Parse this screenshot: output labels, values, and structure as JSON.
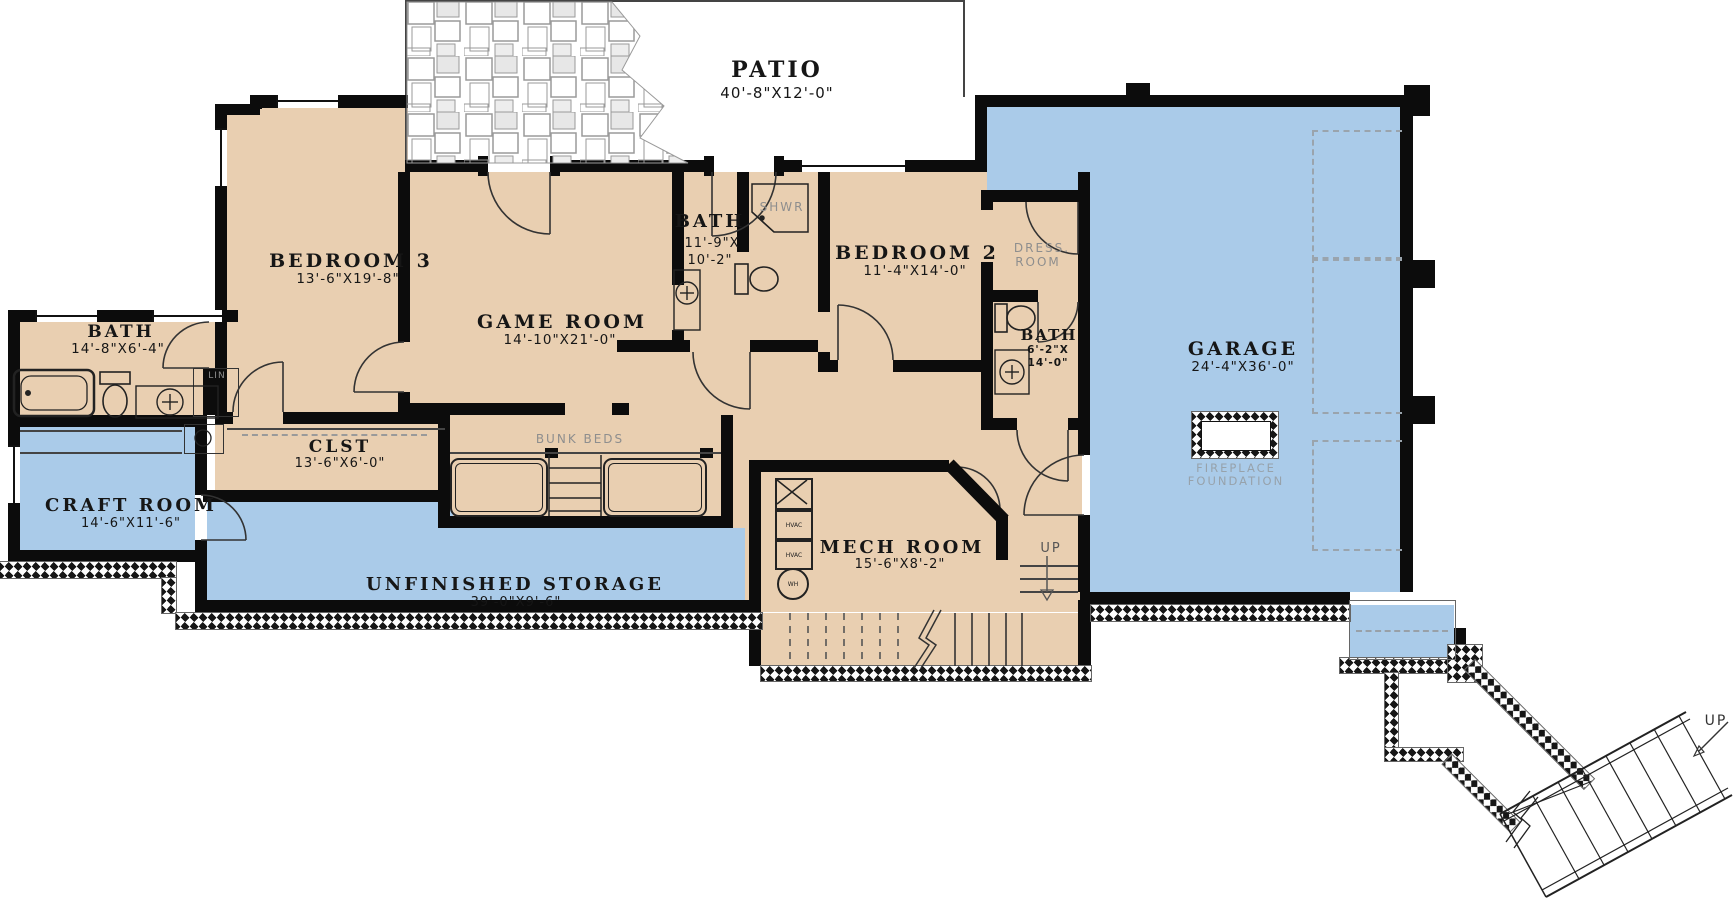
{
  "plan_title": "Basement Floor Plan",
  "rooms": {
    "patio": {
      "name": "PATIO",
      "dims": "40'-8\"X12'-0\""
    },
    "bedroom3": {
      "name": "BEDROOM 3",
      "dims": "13'-6\"X19'-8\""
    },
    "game_room": {
      "name": "GAME ROOM",
      "dims": "14'-10\"X21'-0\""
    },
    "bath_center": {
      "name": "BATH",
      "dims_l1": "11'-9\"X",
      "dims_l2": "10'-2\""
    },
    "bedroom2": {
      "name": "BEDROOM 2",
      "dims": "11'-4\"X14'-0\""
    },
    "bath_left": {
      "name": "BATH",
      "dims": "14'-8\"X6'-4\""
    },
    "bath_right": {
      "name": "BATH",
      "dims_l1": "6'-2\"X",
      "dims_l2": "14'-0\""
    },
    "garage": {
      "name": "GARAGE",
      "dims": "24'-4\"X36'-0\""
    },
    "closet": {
      "name": "CLST",
      "dims": "13'-6\"X6'-0\""
    },
    "craft_room": {
      "name": "CRAFT ROOM",
      "dims": "14'-6\"X11'-6\""
    },
    "storage": {
      "name": "UNFINISHED STORAGE",
      "dims": "39'-0\"X9'-6\""
    },
    "mech_room": {
      "name": "MECH ROOM",
      "dims": "15'-6\"X8'-2\""
    }
  },
  "labels": {
    "shower": "SHWR",
    "dress_l1": "DRESS.",
    "dress_l2": "ROOM",
    "linen": "LIN",
    "bunk_beds": "BUNK BEDS",
    "fireplace_l1": "FIREPLACE",
    "fireplace_l2": "FOUNDATION",
    "up_interior": "UP",
    "up_exterior": "UP",
    "hvac_1": "HVAC",
    "hvac_2": "HVAC",
    "water_heater": "WH"
  },
  "colors": {
    "floor_finished_tan": "#e9cfb1",
    "floor_unfinished_blue": "#aacbe9",
    "wall_black": "#0c0c0c",
    "gray_annotation": "#8e8e8e"
  }
}
